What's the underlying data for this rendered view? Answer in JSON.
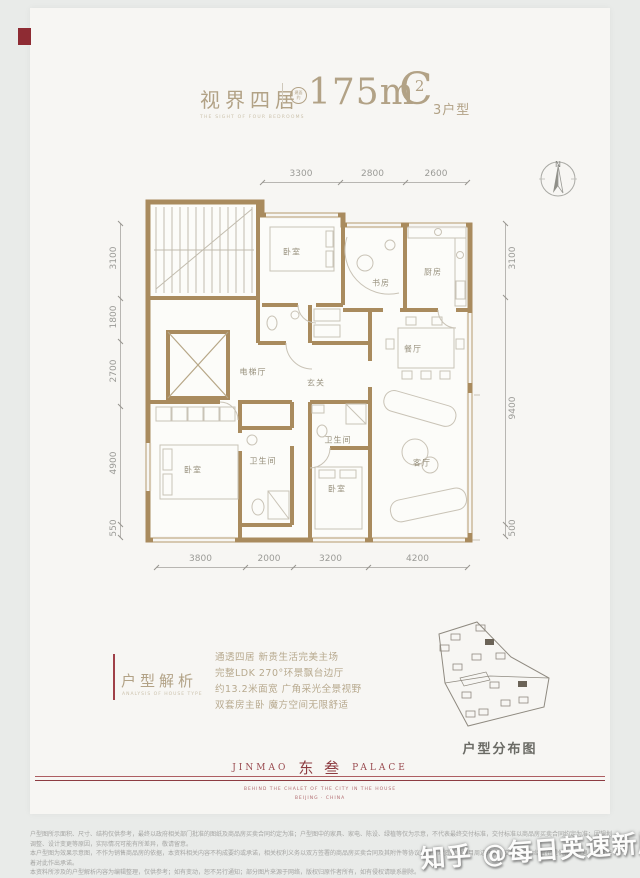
{
  "page": {
    "watermark": "知乎 @每日英速新房"
  },
  "header": {
    "series_title": "视界四居",
    "series_subtitle": "THE SIGHT OF FOUR BEDROOMS",
    "area_badge_line1": "建面",
    "area_badge_line2": "约",
    "area_value": "175m",
    "area_sup": "2",
    "type_letter": "C",
    "type_suffix": "3户型"
  },
  "floorplan": {
    "north_label": "N",
    "dims_top": [
      "3300",
      "2800",
      "2600"
    ],
    "dims_left": [
      "3100",
      "1800",
      "2700",
      "4900",
      "550"
    ],
    "dims_right": [
      "3100",
      "9400",
      "500"
    ],
    "dims_bottom": [
      "3800",
      "2000",
      "3200",
      "4200"
    ],
    "rooms": [
      {
        "label": "卧室"
      },
      {
        "label": "书房"
      },
      {
        "label": "厨房"
      },
      {
        "label": "餐厅"
      },
      {
        "label": "电梯厅"
      },
      {
        "label": "玄关"
      },
      {
        "label": "客厅"
      },
      {
        "label": "卫生间"
      },
      {
        "label": "卫生间"
      },
      {
        "label": "卧室"
      },
      {
        "label": "卧室"
      }
    ]
  },
  "analysis": {
    "title": "户型解析",
    "subtitle": "ANALYSIS OF HOUSE TYPE",
    "lines": [
      "通透四居 新贵生活完美主场",
      "完整LDK 270°环景飘台边厅",
      "约13.2米面宽 广角采光全景视野",
      "双套房主卧 魔方空间无限舒适"
    ]
  },
  "distribution": {
    "title": "户型分布图"
  },
  "brand": {
    "logo_left": "JINMAO",
    "logo_cn": "东 叁",
    "logo_right": "PALACE",
    "tagline": "BEHIND THE CHALET OF THE CITY IN THE HOUSE",
    "location": "BEIJING · CHINA"
  },
  "disclaimer": {
    "line1": "户型图所示面积、尺寸、结构仅供参考，最终以政府相关部门批准的图纸及商品房买卖合同约定为准；户型图中的家具、家电、陈设、绿植等仅为示意，不代表最终交付标准，交付标准以商品房买卖合同约定为准；因规划调整、设计变更等原因，实际情况可能有所差异，敬请留意。",
    "line2": "本户型图为效果示意图，不作为销售商品房的依据，本资料相关内容不构成要约或承诺，相关权利义务以双方签署的商品房买卖合同及其附件等协议为准；本资料对项目周边环境、交通等的介绍旨在提供相关信息，不意味着对此作出承诺。",
    "line3": "本资料所涉及的户型解析内容为编辑整理，仅供参考；如有变动，恕不另行通知；部分图片来源于网络，版权归原作者所有，如有侵权请联系删除。"
  }
}
